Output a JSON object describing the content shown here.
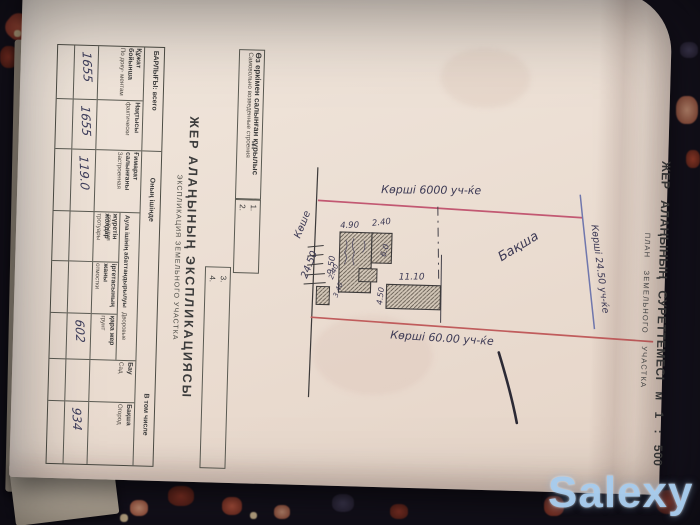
{
  "photo": {
    "watermark": "Salexy"
  },
  "document": {
    "title_kk": "ЖЕР АЛАҢЫНЫҢ СУРЕТТЕМЕСІ м 1 : 500",
    "title_ru": "ПЛАН ЗЕМЕЛЬНОГО УЧАСТКА"
  },
  "plan": {
    "neighbor_top": "Көрші 6000 уч-ќе",
    "neighbor_right": "Көрші 24.50 уч-ќе",
    "neighbor_bottom": "Көрші 60.00 уч-ќе",
    "street_label": "Көше",
    "street_width": "24.50",
    "garden_label": "Бақша",
    "dims": {
      "house_top_a": "4.90",
      "house_top_b": "2.40",
      "house_left": "9.50",
      "house_right": "6.0",
      "barn_top": "11.10",
      "barn_left": "4.50",
      "shed_a": "2.40",
      "shed_b": "3.40"
    }
  },
  "table": {
    "self_built": {
      "kk": "Өз еркімен салынған құрылыс",
      "ru": "Самовольно возведенные строения",
      "slots": [
        "1.",
        "2.",
        "3.",
        "4."
      ]
    },
    "explication_title_kk": "ЖЕР АЛАҢЫНЫҢ ЭКСПЛИКАЦИЯСЫ",
    "explication_title_ru": "ЭКСПЛИКАЦИЯ ЗЕМЕЛЬНОГО УЧАСТКА",
    "total_header": "БАРЛЫҒЫ: всего",
    "incl_header_kk": "Оның ішінде",
    "incl_header_ru": "В том числе",
    "yard_group_kk": "Аула ішінің абаттандырылуы",
    "yard_group_ru": "Дворовые покрытия",
    "columns": [
      {
        "kk": "Құжат бойынша",
        "ru": "По доку- ментам",
        "value": "1655"
      },
      {
        "kk": "Нақтысы",
        "ru": "фактически",
        "value": "1655"
      },
      {
        "kk": "Ғимарат салынғаны",
        "ru": "Застроенная",
        "value": "119.0"
      },
      {
        "kk": "жүретін жолдар",
        "ru": "тротуары",
        "value": ""
      },
      {
        "kk": "іргетасының жаны",
        "ru": "отмостки",
        "value": ""
      },
      {
        "kk": "қара жер",
        "ru": "грунт",
        "value": "602"
      },
      {
        "kk": "Бау",
        "ru": "Сад",
        "value": ""
      },
      {
        "kk": "Бақша",
        "ru": "Огород",
        "value": "934"
      }
    ]
  }
}
